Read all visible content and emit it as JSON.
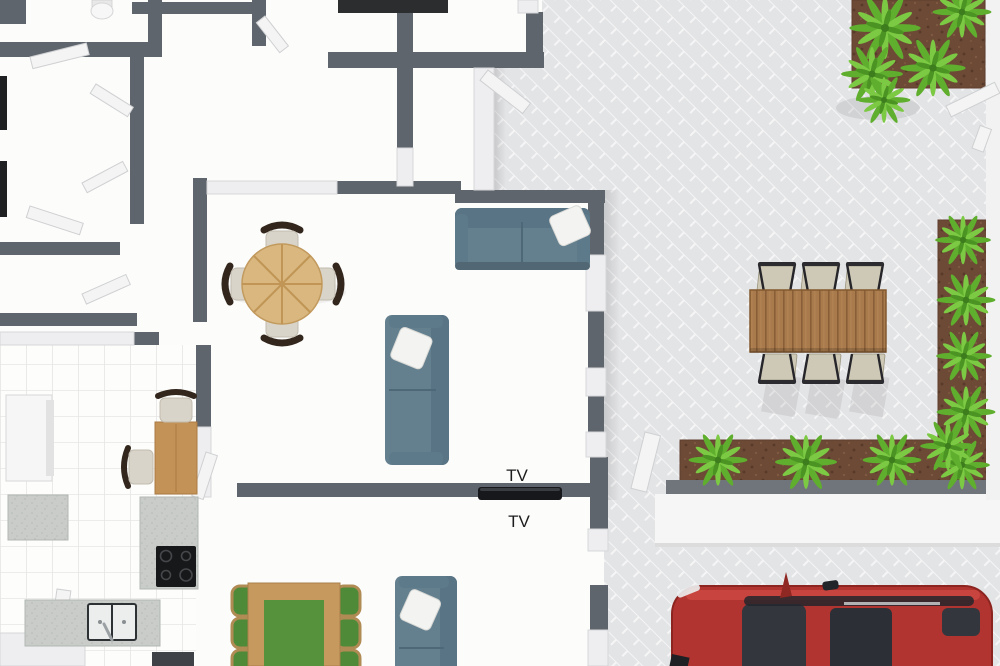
{
  "labels": {
    "tv_wall_upper": "TV",
    "tv_wall_lower": "TV"
  },
  "palette": {
    "wall_dark": "#5e656d",
    "wall_light": "#eeeef0",
    "floor_white": "#fcfcfb",
    "paver_base": "#e3e4e6",
    "paver_line": "#f5f5f6",
    "walkway_white": "#f6f6f6",
    "soil_brown": "#6d4a36",
    "foliage_green": "#5fae2e",
    "foliage_light": "#7cc944",
    "foliage_dark": "#4b9322",
    "sofa_blue": "#64808f",
    "pillow_white": "#f3f3f1",
    "round_table_wood": "#d9b77f",
    "outdoor_table_wood": "#a87a4c",
    "kitchen_table_wood": "#c29256",
    "chair_seat_beige": "#d9d4c9",
    "chair_back_brown": "#33271d",
    "outdoor_chair_beige": "#cec8b6",
    "green_table_top": "#55923b",
    "counter_gray": "#c9ccc9",
    "appliance_black": "#17181a",
    "tv_black": "#17181b",
    "car_red": "#b23430",
    "car_glass": "#33373d"
  },
  "rooms": {
    "living_room_items": [
      "sofa",
      "sofa",
      "round dining table",
      "4 chairs",
      "wall TV"
    ],
    "kitchen_items": [
      "fridge",
      "counters",
      "cooktop",
      "double sink",
      "small table",
      "2 chairs"
    ],
    "bottom_room_items": [
      "dining table with green runner",
      "6 green chairs",
      "sofa"
    ],
    "patio_items": [
      "outdoor dining table",
      "6 outdoor chairs",
      "3 garden beds with ferns",
      "red car",
      "gates"
    ]
  }
}
